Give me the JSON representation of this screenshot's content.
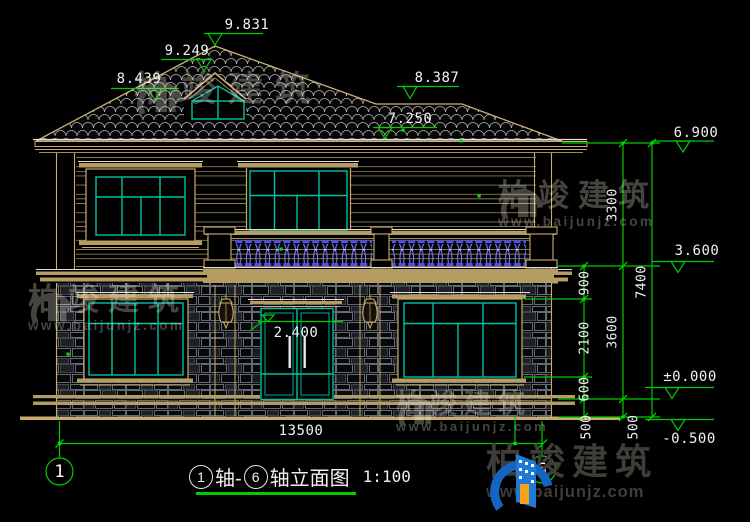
{
  "drawing": {
    "title_mid": "轴-",
    "title_tail": "轴立面图",
    "scale": "1:100",
    "axis_from": "1",
    "axis_to": "6"
  },
  "levels": {
    "ridge": "9.831",
    "dormer_ridge": "9.249",
    "eave_left": "8.439",
    "ridge_right": "8.387",
    "eave_top": "7.250",
    "eave": "6.900",
    "floor2": "3.600",
    "floor1": "±0.000",
    "ground": "-0.500"
  },
  "dims": {
    "overall_width": "13500",
    "door_height": "2.400",
    "v900": "900",
    "v2100": "2100",
    "v600": "600",
    "v500a": "500",
    "v500b": "500",
    "v3300": "3300",
    "v3600": "3600",
    "v7400": "7400"
  },
  "watermark": {
    "name": "柏竣建筑",
    "url": "www.baijunjz.com"
  },
  "brand": {
    "name": "柏竣建筑",
    "url": "www.baijunjz.com"
  },
  "colors": {
    "dim_green": "#00cc00",
    "frame_tan": "#c9ac6c",
    "window_teal": "#00c3a0",
    "baluster_blue": "#6a6af5",
    "brand_blue": "#1976d2"
  }
}
